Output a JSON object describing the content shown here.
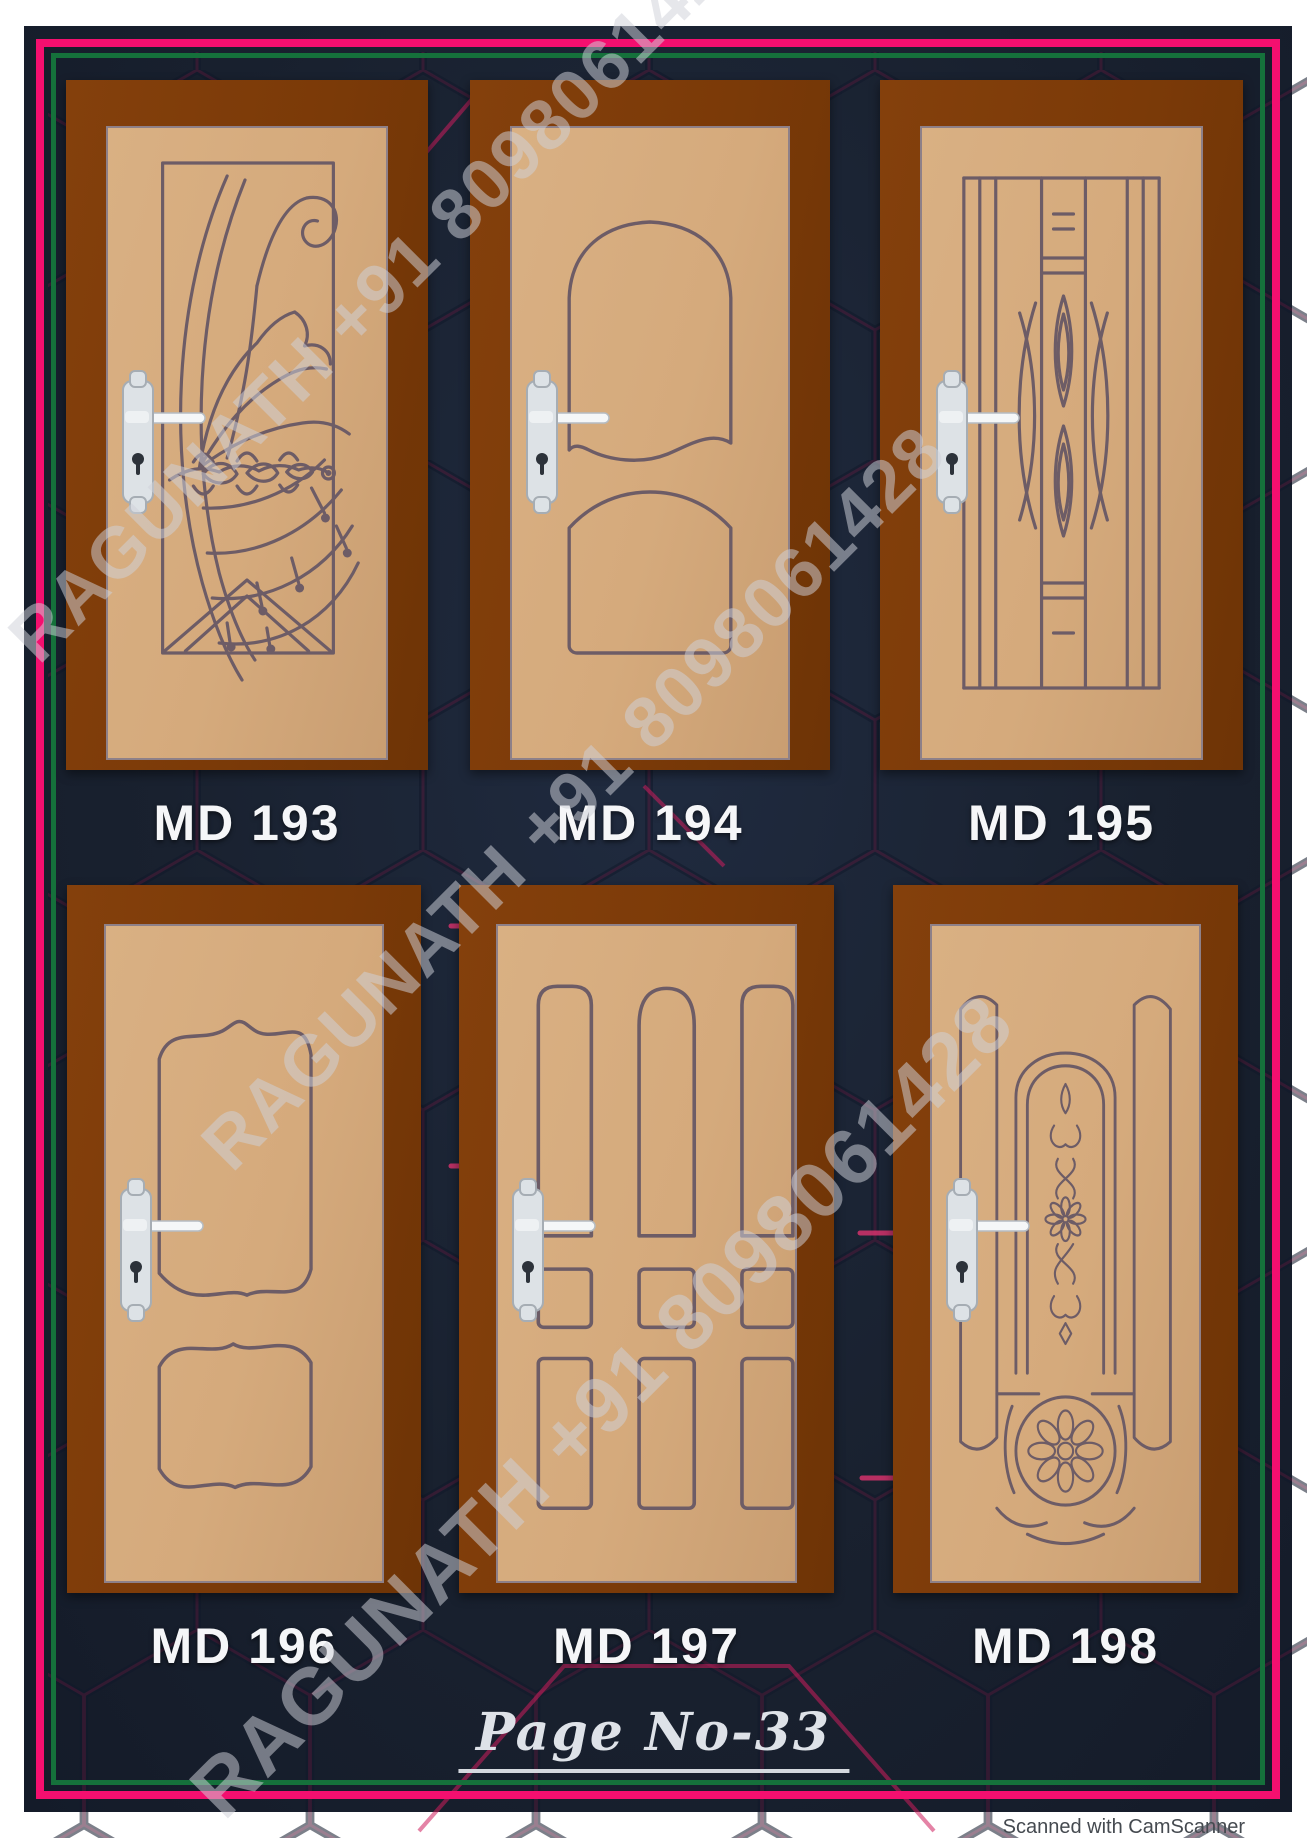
{
  "document": {
    "page_number_label": "Page No-33",
    "watermark_text": "RAGUNATH +91 8098061428",
    "scanner_credit": "Scanned with CamScanner"
  },
  "doors": [
    {
      "label": "MD 193",
      "design": "spiral-wing-fan"
    },
    {
      "label": "MD 194",
      "design": "double-arch-panels"
    },
    {
      "label": "MD 195",
      "design": "vertical-lines-diamonds"
    },
    {
      "label": "MD 196",
      "design": "double-wavy-panels"
    },
    {
      "label": "MD 197",
      "design": "nine-panel-grid"
    },
    {
      "label": "MD 198",
      "design": "ornate-arch-flower-circle"
    }
  ],
  "colors": {
    "background_navy": "#19212f",
    "border_pink": "#f40f6f",
    "border_green": "#15713b",
    "frame_brown": "#7b3a08",
    "door_tan": "#d5aa7c",
    "design_line": "#6d5c66",
    "label_text": "#f5f6f8",
    "hex_accent": "#c2185b"
  }
}
